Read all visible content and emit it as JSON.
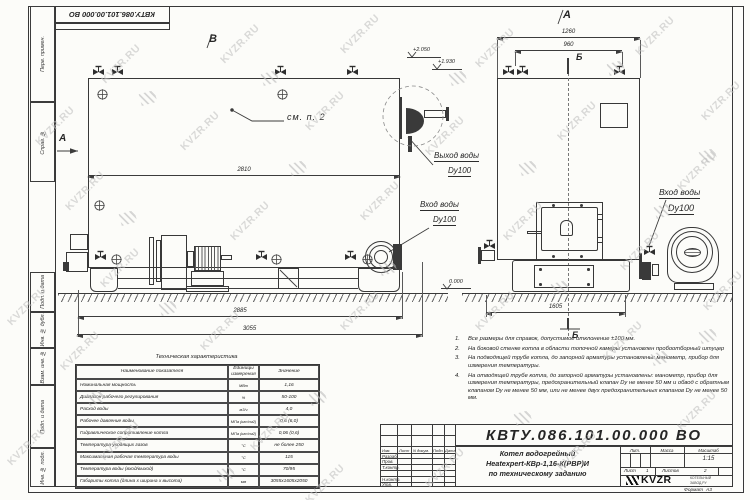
{
  "stamp_top": "КВТУ.086.101.00.000  ВО",
  "doc_number": "КВТУ.086.101.00.000  ВО",
  "watermark": {
    "text": "KVZR.RU"
  },
  "frame_left_labels": [
    "Перв. примен.",
    "Справ. №",
    "Подп. и дата",
    "Инв. № дубл.",
    "Взам. инв. №",
    "Подп. и дата",
    "Инв. № подл."
  ],
  "views": {
    "side": {
      "label": "В",
      "view_arrow_label": "А",
      "detail_callout": "см. п. 2",
      "outlet_line1": "Выход воды",
      "outlet_line2": "Dy100",
      "inlet_line1": "Вход воды",
      "inlet_line2": "Dy100",
      "dim_inner": "2810",
      "dim_base": "2885",
      "dim_total": "3055",
      "elev_top": "+2.050",
      "elev_mid": "+1.930",
      "elev_zero": "0.000"
    },
    "front": {
      "label": "А",
      "section_label_top": "Б",
      "section_label_bottom": "Б",
      "dim_top": "1260",
      "dim_valves": "960",
      "dim_base": "1605",
      "inlet_line1": "Вход воды",
      "inlet_line2": "Dy100"
    }
  },
  "notes": [
    "Все размеры для справок, допустимое отклонение ±100 мм.",
    "На боковой стенке котла в области топочной камеры установлен пробоотборный штуцер",
    "На подводящей трубе котла, до запорной арматуры установлены: манометр, прибор для измерения температуры.",
    "На отводящей трубе котла, до запорной арматуры установлены: манометр, прибор для измерения температуры, предохранительный клапан Dу не менее 50 мм и обвод с обратным клапаном Dу не менее 50 мм, или не менее двух предохранительных клапанов Dу не менее 50 мм."
  ],
  "spec_table": {
    "title": "Техническая характеристика",
    "headers": [
      "Наименование показателя",
      "Единицы измерения",
      "Значение"
    ],
    "rows": [
      [
        "Номинальная мощность",
        "МВт",
        "1,16"
      ],
      [
        "Диапазон рабочего регулирования",
        "%",
        "50-100"
      ],
      [
        "Расход воды",
        "м3/ч",
        "4,0"
      ],
      [
        "Рабочее давление воды",
        "МПа (кгс/см2)",
        "0,6 (6,0)"
      ],
      [
        "Гидравлическое сопротивление котла",
        "МПа (кгс/см2)",
        "0,06 (0,6)"
      ],
      [
        "Температура уходящих газов",
        "°С",
        "не более 250"
      ],
      [
        "Максимальная рабочая температура воды",
        "°С",
        "115"
      ],
      [
        "Температура воды (вход/выход)",
        "°С",
        "70/95"
      ],
      [
        "Габариты котла (длина х ширина х высота)",
        "мм",
        "3055х1605х2050"
      ]
    ]
  },
  "title_block": {
    "header_cols": [
      "Изм.",
      "Лист",
      "N докум.",
      "Подп.",
      "Дата"
    ],
    "row_labels": [
      "Разраб.",
      "Пров.",
      "Т.контр.",
      "Н.контр.",
      "Утв."
    ],
    "product_title_line1": "Котел водогрейный",
    "product_title_line2": "Heatexpert-КВр-1,16-К(РВР)И",
    "product_title_line3": "по техническому заданию",
    "lit_label": "Лит.",
    "mass_label": "Масса",
    "scale_label": "Масштаб",
    "scale_value": "1:15",
    "sheet_label": "Лист",
    "sheet_value": "1",
    "sheets_label": "Листов",
    "sheets_value": "2",
    "logo_text": "KVZR",
    "logo_caption1": "КОТЕЛЬНЫЙ",
    "logo_caption2": "ЗАВОД.РУ",
    "format_label": "Формат",
    "format_value": "А3"
  }
}
